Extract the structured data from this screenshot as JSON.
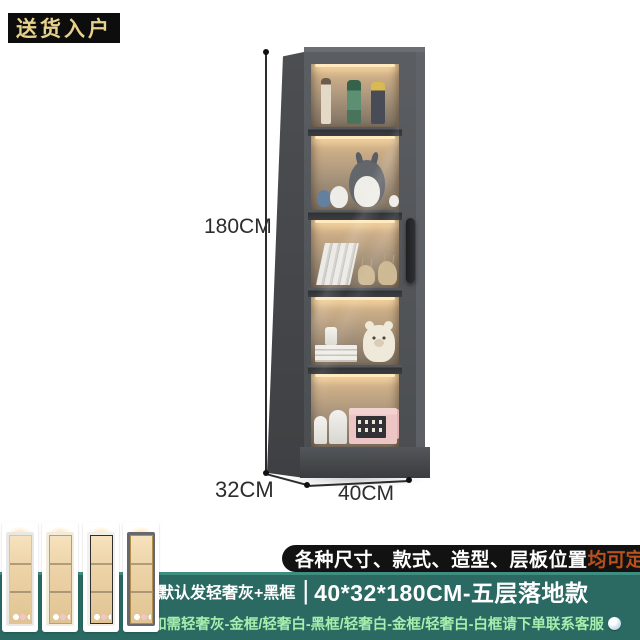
{
  "delivery_badge": {
    "label": "送货入户",
    "bg": "#0d0d0d",
    "text_color": "#e7d28c"
  },
  "dimensions": {
    "height": "180CM",
    "depth": "32CM",
    "width": "40CM"
  },
  "cabinet": {
    "frame_color": "#54575b",
    "side_color": "#46484c",
    "interior_glow_color": "#e9c896",
    "handle_color": "#26282a",
    "shelves": [
      {
        "items": [
          "anime-figurine-tan",
          "anime-figurine-green-hair",
          "anime-figurine-blond"
        ]
      },
      {
        "items": [
          "totoro-blue-small",
          "totoro-white-medium",
          "totoro-gray-large",
          "totoro-white-mini"
        ]
      },
      {
        "items": [
          "leaning-white-books",
          "deer-figurine-small",
          "deer-figurine-large"
        ]
      },
      {
        "items": [
          "white-cup",
          "stacked-books",
          "plush-bear-cream"
        ]
      },
      {
        "items": [
          "sculpture-head-small",
          "sculpture-head-large",
          "pink-gift-box-back",
          "pink-gift-box-front"
        ]
      }
    ]
  },
  "footer": {
    "teal_color": "#2a6a63",
    "banner": {
      "text": "各种尺寸、款式、造型、层板位置",
      "highlight": "均可定制",
      "bg": "#121212",
      "highlight_color": "#b8511d"
    },
    "row2": {
      "prefix": "默认发轻奢灰+黑框",
      "divider": "|",
      "size": "40*32*180CM-五层落地款"
    },
    "row3": {
      "text": "如需轻奢灰-金框/轻奢白-黑框/轻奢白-金框/轻奢白-白框请下单联系客服",
      "text_color": "#a7edae"
    },
    "variants": [
      {
        "name": "white-body-white-frame",
        "body": "#e9e8e4",
        "frame": "#c9c7c2"
      },
      {
        "name": "white-body-gold-frame",
        "body": "#f2ecdc",
        "frame": "#c59f55"
      },
      {
        "name": "white-body-black-frame",
        "body": "#f1f0ed",
        "frame": "#2f2f2f"
      },
      {
        "name": "gray-body-gold-frame",
        "body": "#66686d",
        "frame": "#b08e4d"
      }
    ]
  }
}
